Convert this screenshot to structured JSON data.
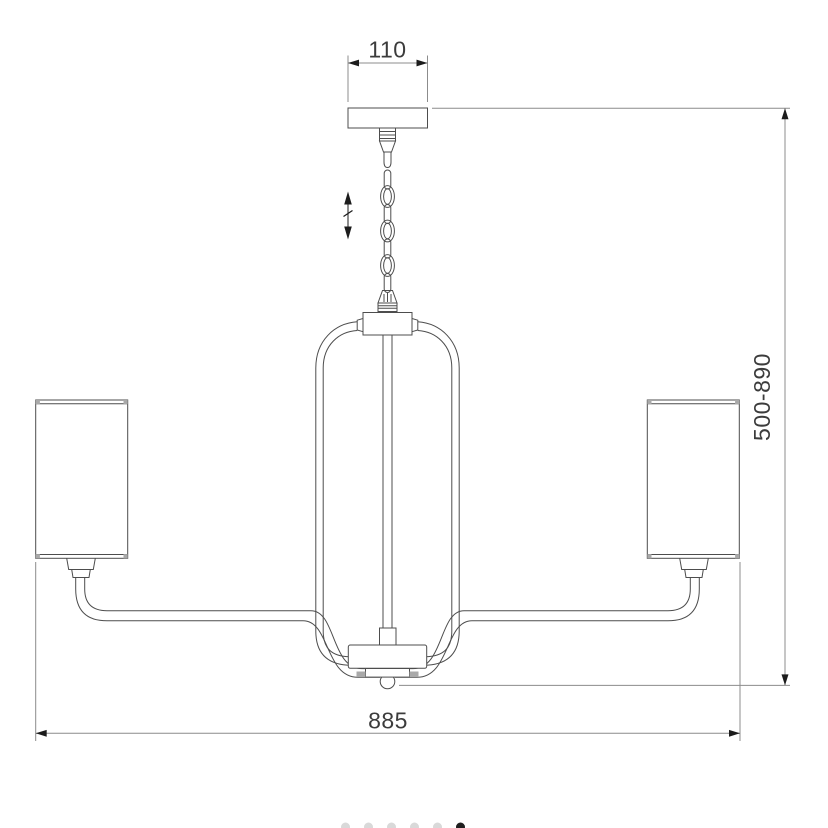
{
  "drawing": {
    "subject": "chandelier-pendant-technical-dimension-diagram",
    "background_color": "#ffffff",
    "line_color": "#4d4d4d",
    "detail_color": "#a9a9a9",
    "dimension_line_color": "#8c8c8c",
    "arrow_color": "#1c1c1c",
    "text_color": "#3c3c3c"
  },
  "dimensions": {
    "canopy_width": "110",
    "height_range": "500-890",
    "total_width": "885"
  },
  "pagination": {
    "dot_count": 6,
    "active_index": 5,
    "inactive_color": "#d9d9d9",
    "active_color": "#1f1f1f"
  }
}
